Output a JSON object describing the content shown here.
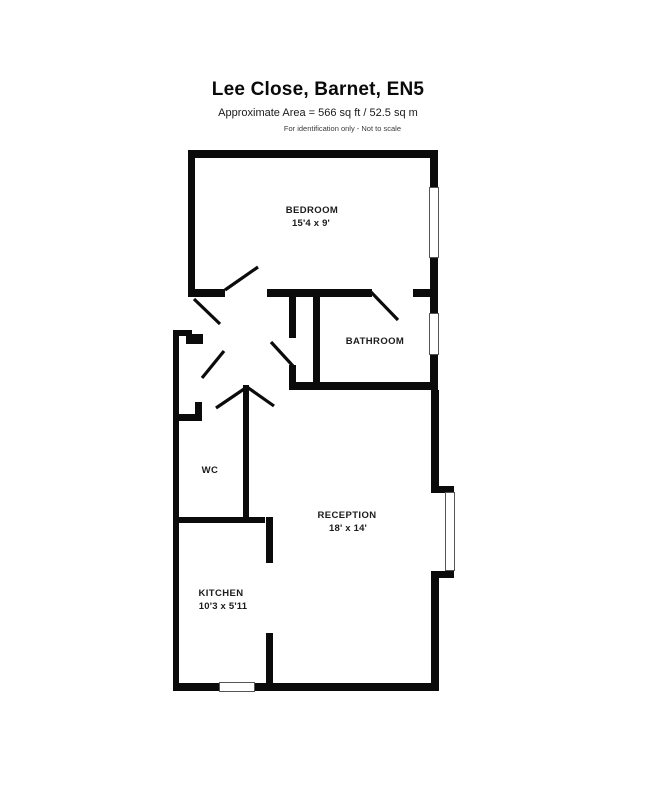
{
  "header": {
    "title": "Lee Close, Barnet, EN5",
    "subtitle": "Approximate Area = 566 sq ft / 52.5 sq m",
    "disclaimer": "For identification only - Not to scale"
  },
  "rooms": {
    "bedroom": {
      "name": "BEDROOM",
      "dims": "15'4 x 9'"
    },
    "bathroom": {
      "name": "BATHROOM"
    },
    "wc": {
      "name": "WC"
    },
    "reception": {
      "name": "RECEPTION",
      "dims": "18' x 14'"
    },
    "kitchen": {
      "name": "KITCHEN",
      "dims": "10'3 x 5'11"
    }
  },
  "colors": {
    "wall": "#0b0b0b",
    "background": "#ffffff",
    "window_fill": "#ffffff",
    "window_border": "#555555"
  }
}
